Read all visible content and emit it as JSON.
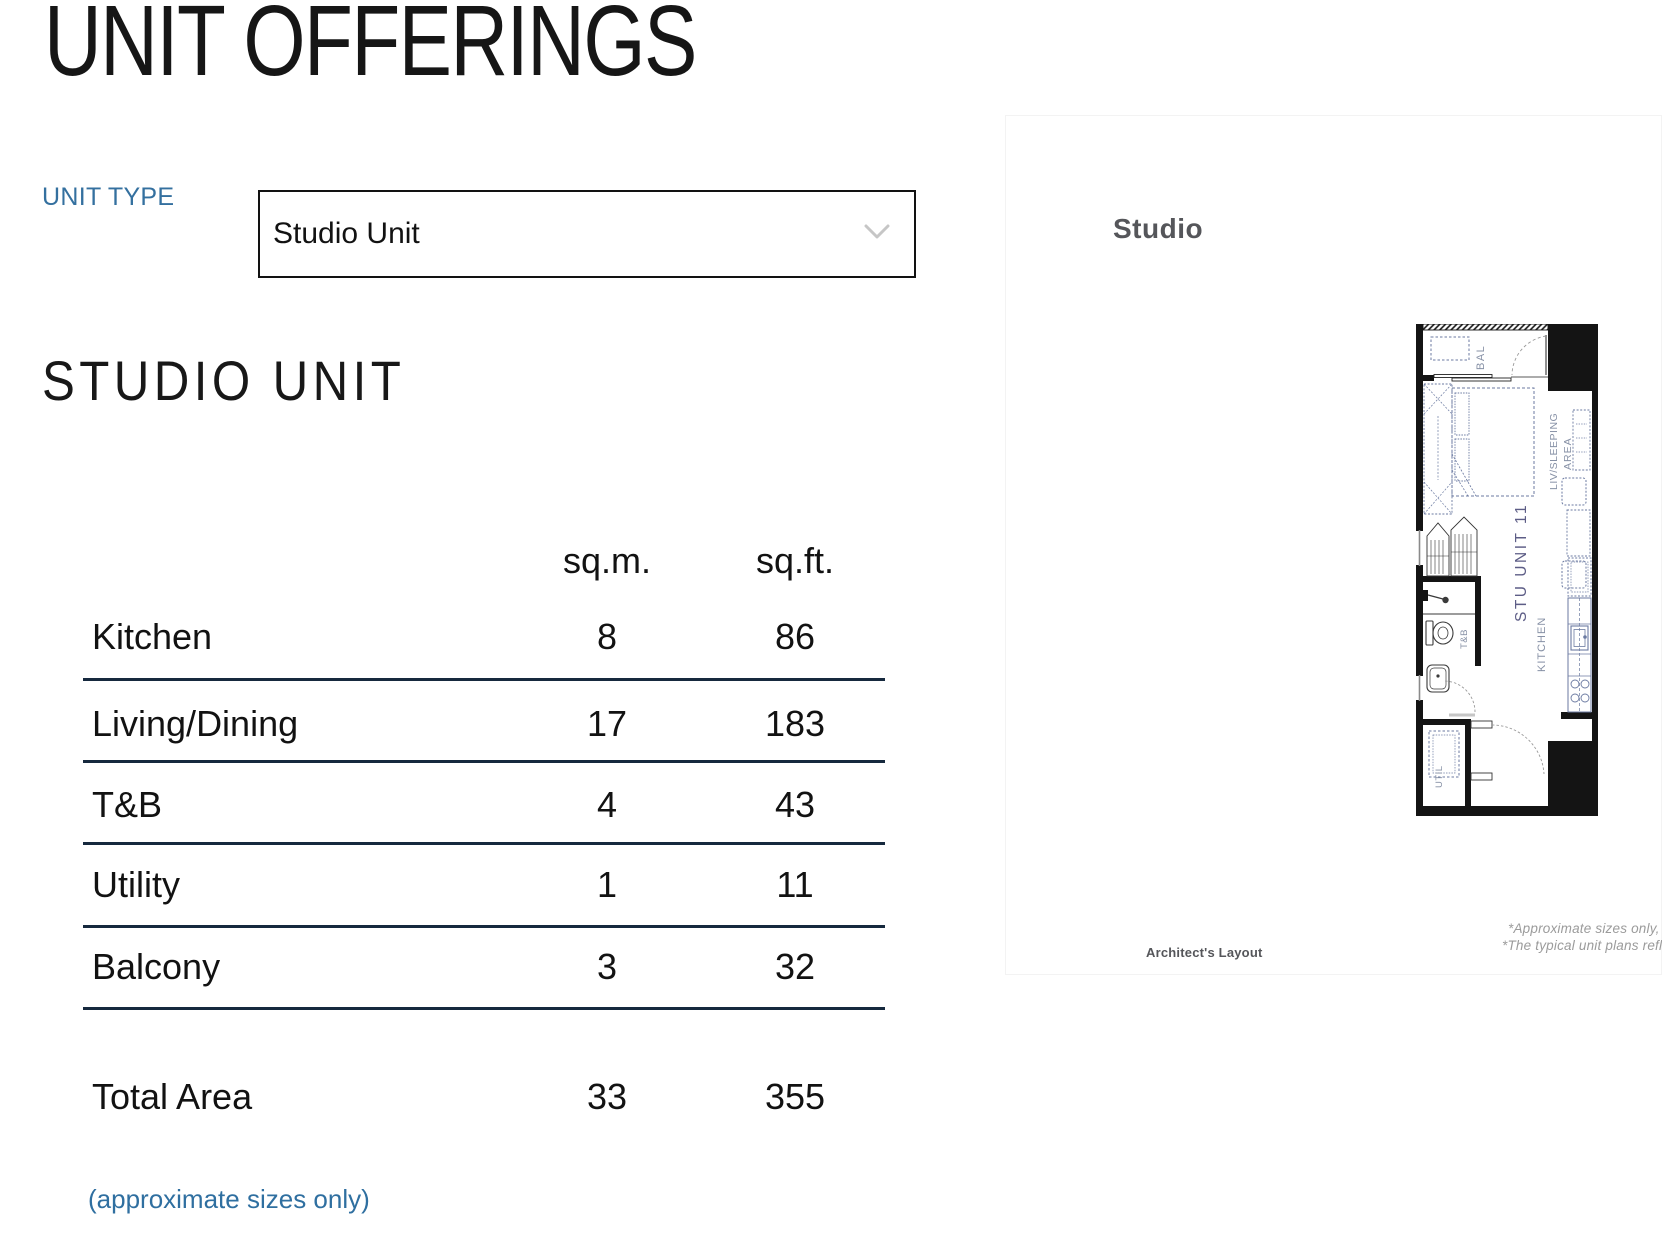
{
  "page": {
    "title": "UNIT OFFERINGS",
    "section_heading": "STUDIO UNIT",
    "approx_note": "(approximate sizes only)"
  },
  "unit_type": {
    "label": "UNIT TYPE",
    "value": "Studio Unit"
  },
  "table": {
    "columns": [
      "sq.m.",
      "sq.ft."
    ],
    "rows": [
      {
        "label": "Kitchen",
        "sqm": "8",
        "sqft": "86"
      },
      {
        "label": "Living/Dining",
        "sqm": "17",
        "sqft": "183"
      },
      {
        "label": "T&B",
        "sqm": "4",
        "sqft": "43"
      },
      {
        "label": "Utility",
        "sqm": "1",
        "sqft": "11"
      },
      {
        "label": "Balcony",
        "sqm": "3",
        "sqft": "32"
      }
    ],
    "total": {
      "label": "Total Area",
      "sqm": "33",
      "sqft": "355"
    }
  },
  "plan_panel": {
    "title": "Studio",
    "caption": "Architect's Layout",
    "disclaimer_line1": "*Approximate sizes only, r",
    "disclaimer_line2": "*The typical unit plans refle",
    "labels": {
      "bal": "BAL",
      "living1": "LIV/SLEEPING",
      "living2": "AREA",
      "unit": "STU UNIT 11",
      "kitchen": "KITCHEN",
      "bath": "T&B",
      "util": "UTIL"
    }
  },
  "icons": {
    "dropdown_chevron": "chevron-down"
  },
  "colors": {
    "accent_blue": "#34709f",
    "note_blue": "#2f6fa0",
    "table_line_navy": "#16293e",
    "text_black": "#161616",
    "panel_gray": "#55565a",
    "disclaimer_gray": "#9b9b9b",
    "plan_line_blue": "#6b7aa1",
    "plan_label_gray": "#8791a6",
    "plan_unit_purple": "#5d5d86",
    "chevron_gray": "#c6c6c6"
  }
}
